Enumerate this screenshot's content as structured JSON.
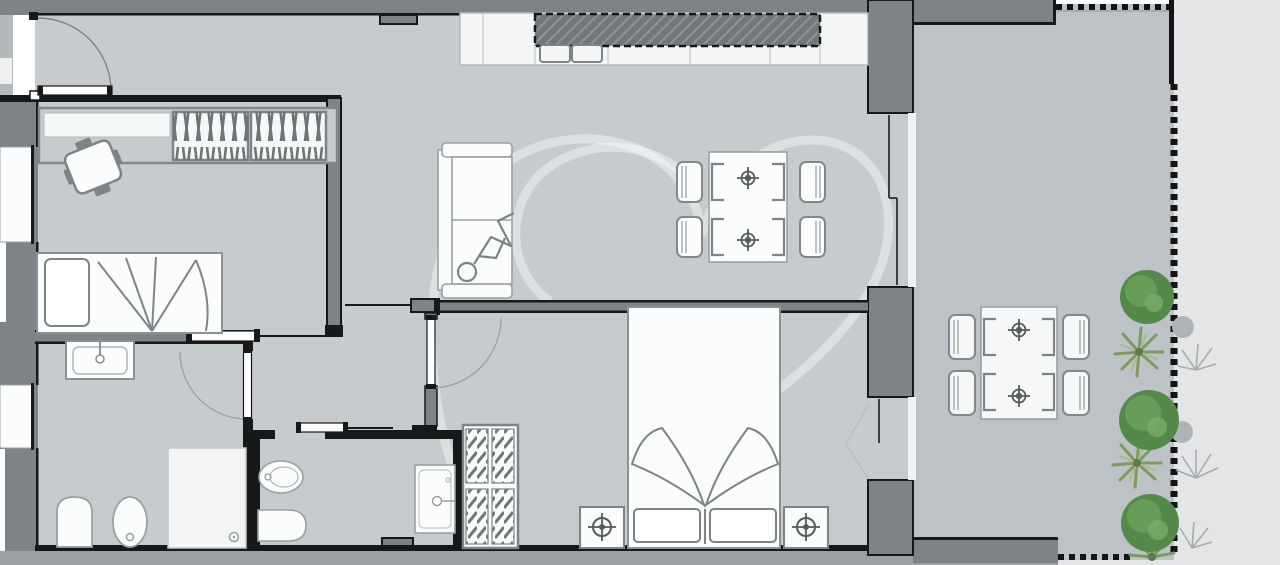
{
  "title": "apartment-floor-plan",
  "colors": {
    "exterior": "#e4e5e6",
    "floor": "#c6cbce",
    "terrace_floor": "#bcc2c5",
    "wall": "#7d8387",
    "wall_dark": "#17181a",
    "band": "#9aa0a3",
    "recess": "#b4b9bc",
    "fixture_white": "#fafbfb",
    "fixture_outline": "#8a9094",
    "soft_outline": "#9aa0a3",
    "tree_green": "#55894a",
    "tree_light": "#7bab69",
    "palm_green": "#7e9a62",
    "palm_light": "#a9bb8a",
    "plant_gray": "#a7acaf",
    "watermark": "#ffffff"
  },
  "scene": {
    "type": "architectural-floor-plan",
    "rooms": [
      {
        "name": "entrance-hall",
        "features": [
          "entry-door-swing"
        ]
      },
      {
        "name": "second-bedroom",
        "furniture": [
          "bookshelf",
          "small-table-with-chairs",
          "single-bed"
        ]
      },
      {
        "name": "bathroom-1",
        "fixtures": [
          "washbasin",
          "toilet",
          "bidet",
          "shower"
        ]
      },
      {
        "name": "hallway",
        "features": [
          "sliding-doors",
          "swing-doors"
        ]
      },
      {
        "name": "bathroom-2",
        "fixtures": [
          "bidet",
          "toilet",
          "washbasin"
        ]
      },
      {
        "name": "living-kitchen",
        "furniture": [
          "kitchen-counter",
          "kitchen-sink",
          "sofa-with-person",
          "dining-table-4-chairs"
        ]
      },
      {
        "name": "master-bedroom",
        "furniture": [
          "wardrobe",
          "double-bed",
          "nightstand-left",
          "nightstand-right"
        ]
      },
      {
        "name": "terrace",
        "furniture": [
          "outdoor-table-4-chairs"
        ],
        "features": [
          "railing-dashed",
          "trees",
          "palms",
          "ferns"
        ]
      }
    ],
    "watermark": "heart-logo-outline"
  }
}
